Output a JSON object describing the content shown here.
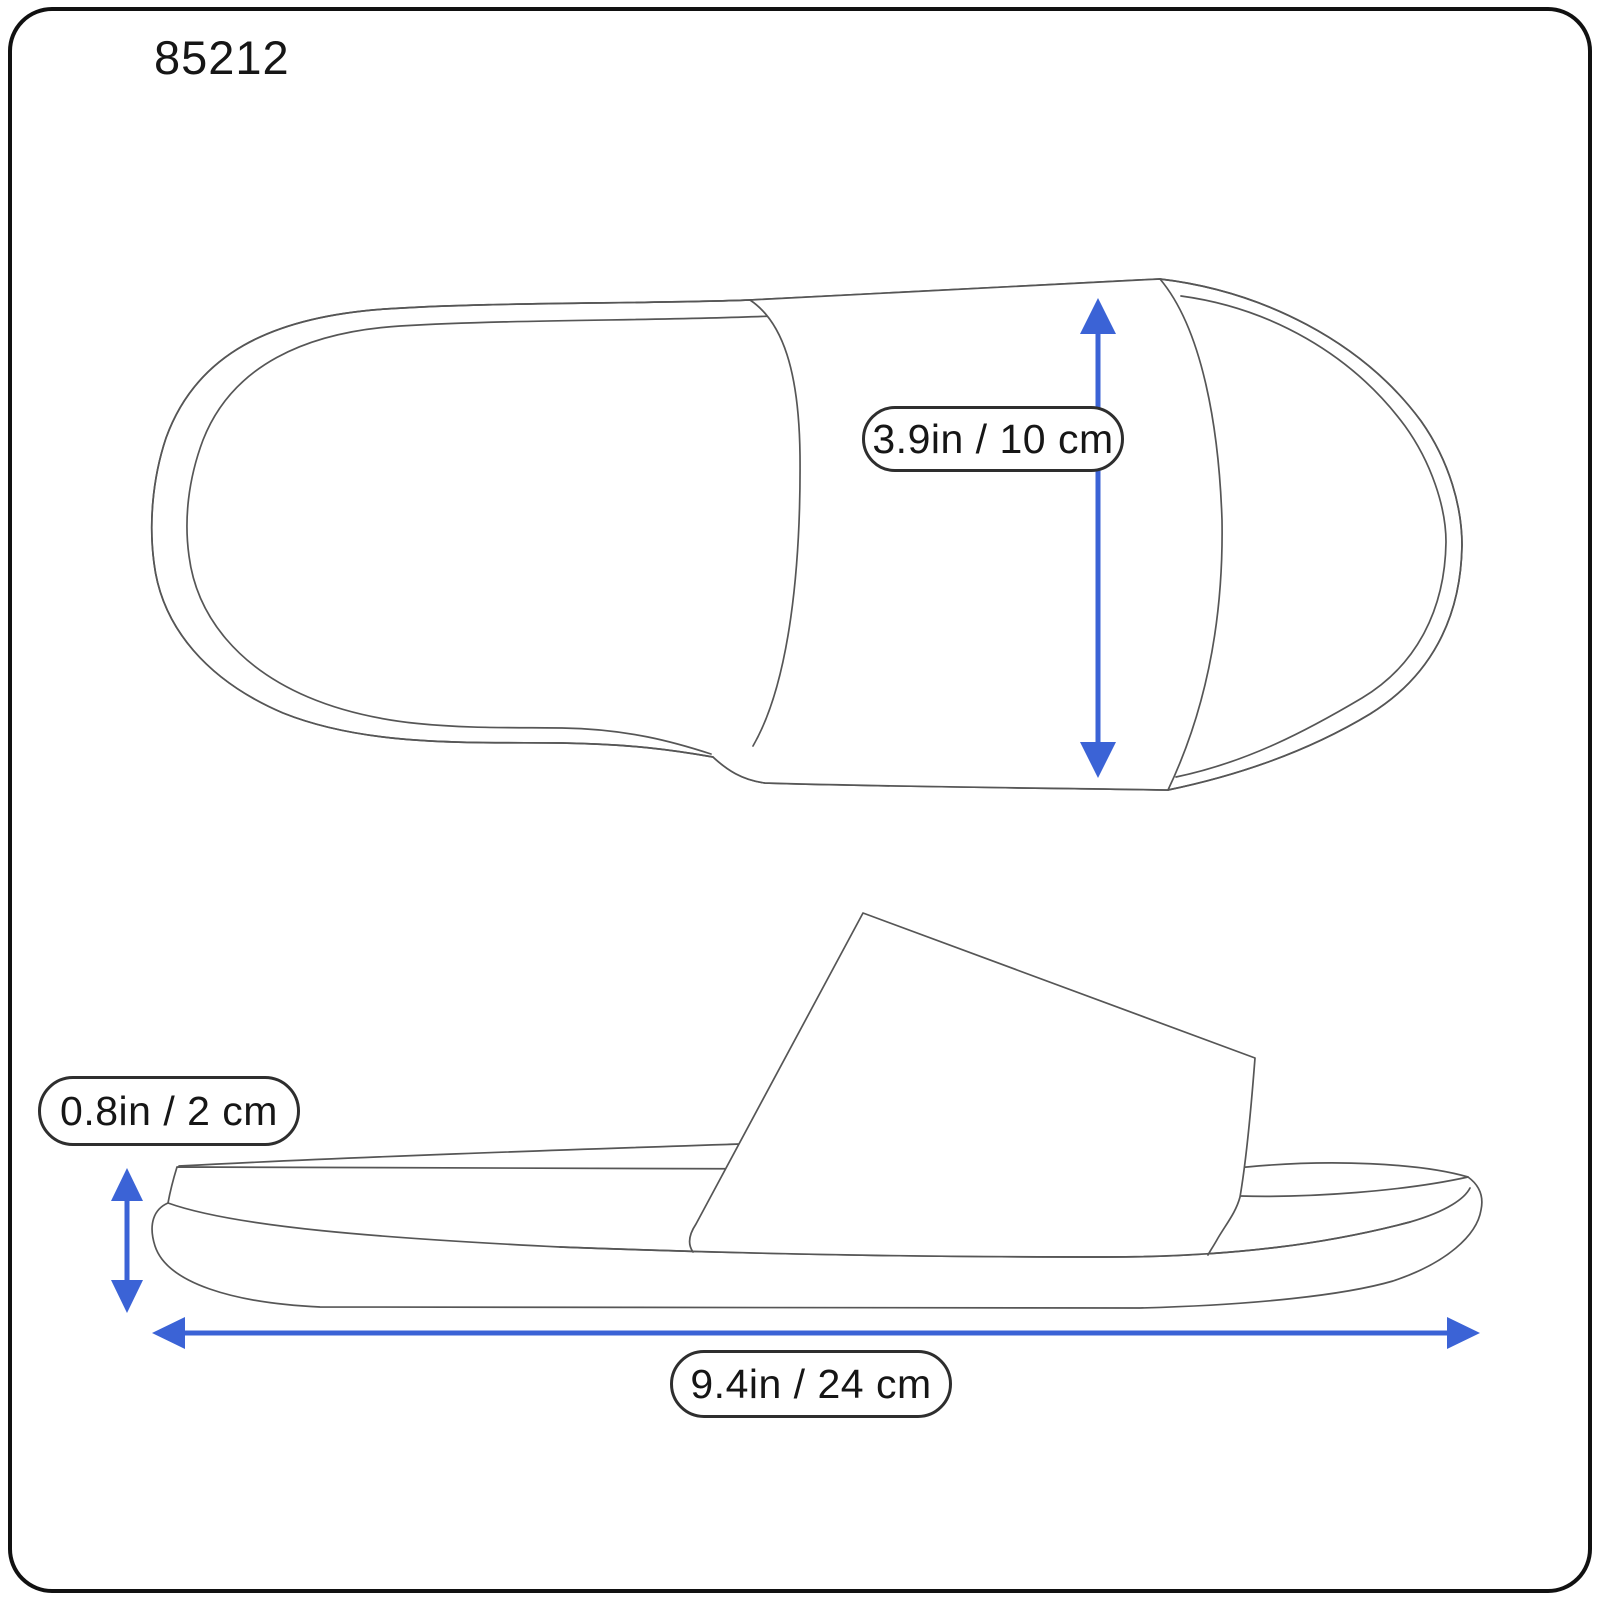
{
  "diagram": {
    "model_number": "85212",
    "measurements": {
      "strap_width": "3.9in / 10 cm",
      "sole_height": "0.8in / 2 cm",
      "length": "9.4in / 24 cm"
    },
    "colors": {
      "accent_blue": "#3b63d6",
      "sketch_line": "#565656",
      "frame": "#111111"
    }
  }
}
